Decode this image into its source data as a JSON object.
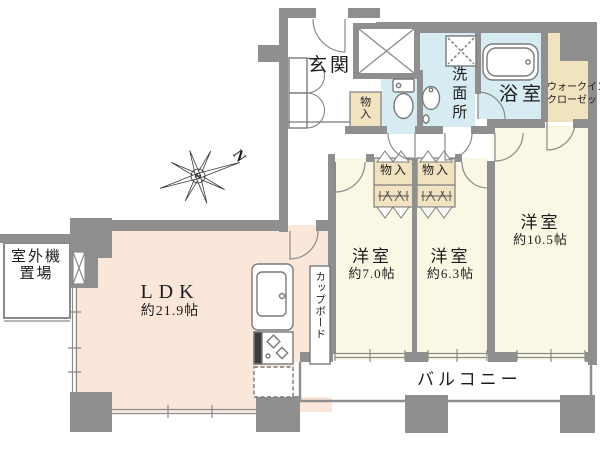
{
  "colors": {
    "wall": "#8f8f8f",
    "line": "#7e7e7e",
    "ldk": "#fbe7d9",
    "bedroom": "#faf7e4",
    "wet": "#d7ecf2",
    "closet": "#f1e2c0",
    "text": "#1c1c1c"
  },
  "compass": {
    "north_label": "N"
  },
  "rooms": {
    "genkan": {
      "label": "玄関"
    },
    "entrance_storage": {
      "label": "物入"
    },
    "washroom": {
      "label": "洗面所"
    },
    "bathroom": {
      "label": "浴室"
    },
    "walk_in_closet": {
      "line1": "ウォークイン",
      "line2": "クローゼット"
    },
    "closet_a": {
      "label": "物入"
    },
    "closet_b": {
      "label": "物入"
    },
    "bedroom1": {
      "label": "洋室",
      "size": "約7.0帖"
    },
    "bedroom2": {
      "label": "洋室",
      "size": "約6.3帖"
    },
    "bedroom3": {
      "label": "洋室",
      "size": "約10.5帖"
    },
    "ldk": {
      "label": "LDK",
      "size": "約21.9帖"
    },
    "cupboard": {
      "label": "カップボード"
    },
    "balcony": {
      "label": "バルコニー"
    },
    "outdoor_unit": {
      "line1": "室外機",
      "line2": "置場"
    }
  }
}
